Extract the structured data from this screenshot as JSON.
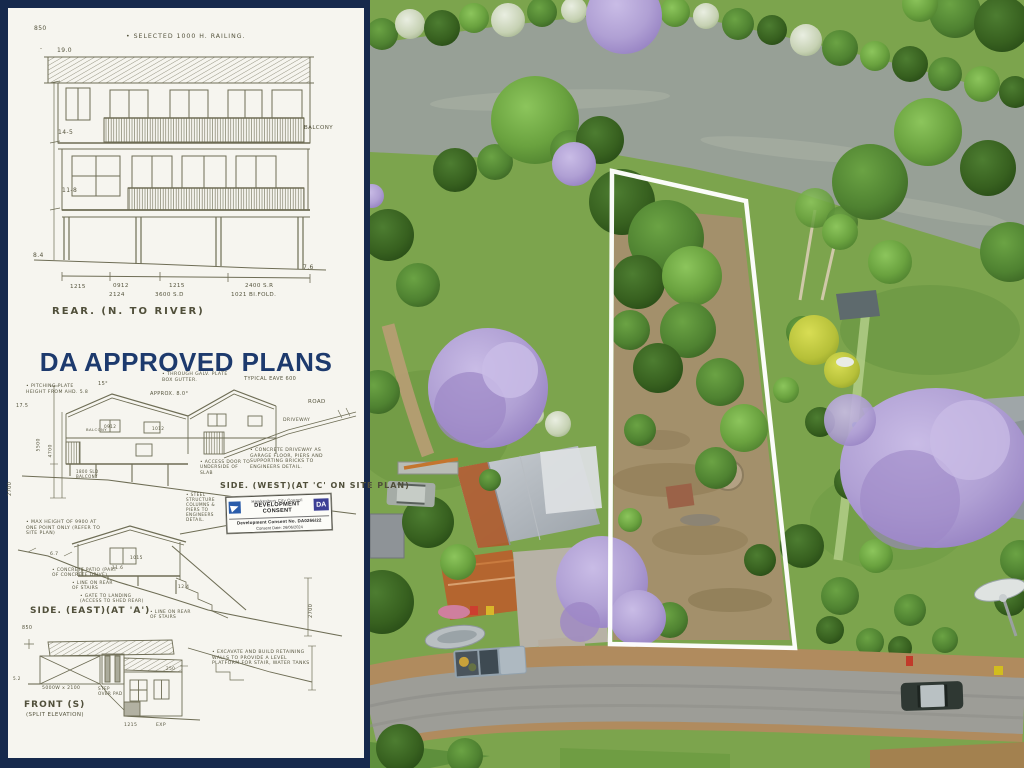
{
  "colors": {
    "border_navy": "#16294c",
    "headline_navy": "#1d3a6d",
    "ink": "#6e6d55",
    "paper": "#f6f5ef",
    "stamp_logo_blue": "#2a5caa",
    "stamp_badge_indigo": "#3c3f95",
    "river": "#97a096",
    "lawn": "#7ca44d",
    "jacaranda": "#b0a0d4",
    "rust_roof": "#ad5b2b",
    "road": "#9d9d97",
    "lot_outline": "#ffffff"
  },
  "plans": {
    "headline": "DA APPROVED PLANS",
    "rear": {
      "datum": "850",
      "railing_note": "• SELECTED 1000 H. RAILING.",
      "dim_width": "19.0",
      "balcony": "BALCONY",
      "dim_mid": "14-5",
      "dim_low": "11-8",
      "dim_gl": "8.4",
      "dim_gr": "7.6",
      "dims_bottom": [
        "1215",
        "0912",
        "2124",
        "1215",
        "3600 S.D",
        "2400 S.R",
        "1021 BI.FOLD."
      ],
      "caption": "REAR. (N. TO RIVER)"
    },
    "side_west": {
      "pitch_note": "• PITCHING PLATE HEIGHT FROM AHD. 5.8",
      "dim_a": "17.5",
      "roof_slope": "15°",
      "approx": "APPROX. 8.0°",
      "gutter_note": "• THROUGH GALV. PLATE BOX GUTTER.",
      "eave_note": "TYPICAL EAVE 600",
      "road": "ROAD",
      "driveway": "DRIVEWAY",
      "dim_b": "5500",
      "dim_c": "4700",
      "dim_d": "2700",
      "balcony": "BALCONY",
      "win_a": "0912",
      "win_b": "1012",
      "sld": "1800 SLD BALCONY",
      "door_note": "• ACCESS DOOR TO UNDERSIDE OF SLAB",
      "driveway_note": "• CONCRETE DRIVEWAY AS GARAGE FLOOR, PIERS AND SUPPORTING BRICKS TO ENGINEERS DETAIL.",
      "structure_note": "• STEEL STRUCTURE COLUMNS & PIERS TO ENGINEERS DETAIL.",
      "caption": "SIDE. (WEST)(AT 'C' ON SITE PLAN)"
    },
    "stamp": {
      "council": "Hawkesbury City Council",
      "title_1": "DEVELOPMENT",
      "title_2": "CONSENT",
      "badge": "DA",
      "consent_no": "Development Consent No. DA0266/22",
      "consent_date": "Consent Date: 26/06/2024"
    },
    "side_east": {
      "height_note": "• MAX HEIGHT OF 9900 AT ONE POINT ONLY (REFER TO SITE PLAN)",
      "dim_a": "6.7",
      "patio_note": "• CONCRETE PATIO (PART OF CONCRETE DRIVE)",
      "stair_note": "• LINE ON REAR OF STAIRS",
      "gate_note": "• GATE TO LANDING (ACCESS TO SHED REAR)",
      "win_a": "1015",
      "dim_b": "11.6",
      "dim_c": "12.4",
      "stair_note2": "• LINE ON REAR OF STAIRS",
      "dim_d": "2700",
      "caption": "SIDE. (EAST)(AT 'A')"
    },
    "front": {
      "datum": "850",
      "garage_dim": "5000W x 2100",
      "pad_note": "STEP OVER PAD",
      "dim_a": "5.2",
      "dim_b": "250",
      "win_a": "1215",
      "win_b": "EXP",
      "caption": "FRONT (S)",
      "caption_sub": "(SPLIT ELEVATION)",
      "retaining_note": "• EXCAVATE AND BUILD RETAINING WALLS TO PROVIDE A LEVEL PLATFORM FOR STAIR, WATER TANKS"
    }
  }
}
